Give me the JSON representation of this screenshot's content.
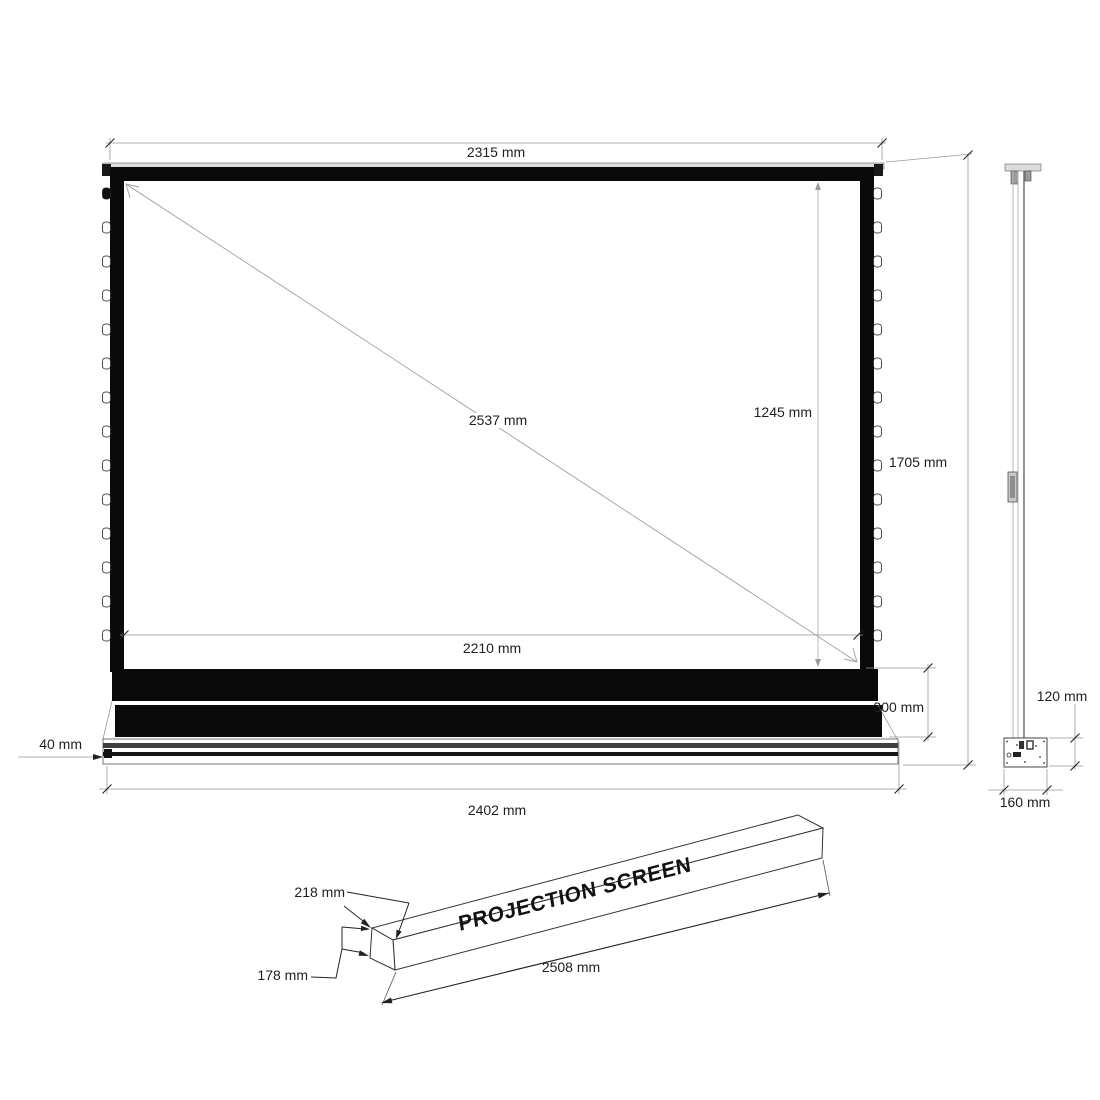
{
  "front": {
    "top_width": "2315 mm",
    "diagonal": "2537 mm",
    "viewing_height": "1245 mm",
    "overall_height": "1705 mm",
    "viewing_width": "2210 mm",
    "housing_height": "300 mm",
    "base_height": "40 mm",
    "overall_width": "2402 mm"
  },
  "side": {
    "upper_depth": "120 mm",
    "base_depth": "160 mm"
  },
  "package": {
    "label": "PROJECTION SCREEN",
    "depth": "218 mm",
    "height": "178 mm",
    "length": "2508 mm"
  },
  "colors": {
    "frame": "#0a0a0a",
    "dim_line": "#999999",
    "text": "#1f1f1f",
    "cap_strip": "#dcdcdc"
  }
}
